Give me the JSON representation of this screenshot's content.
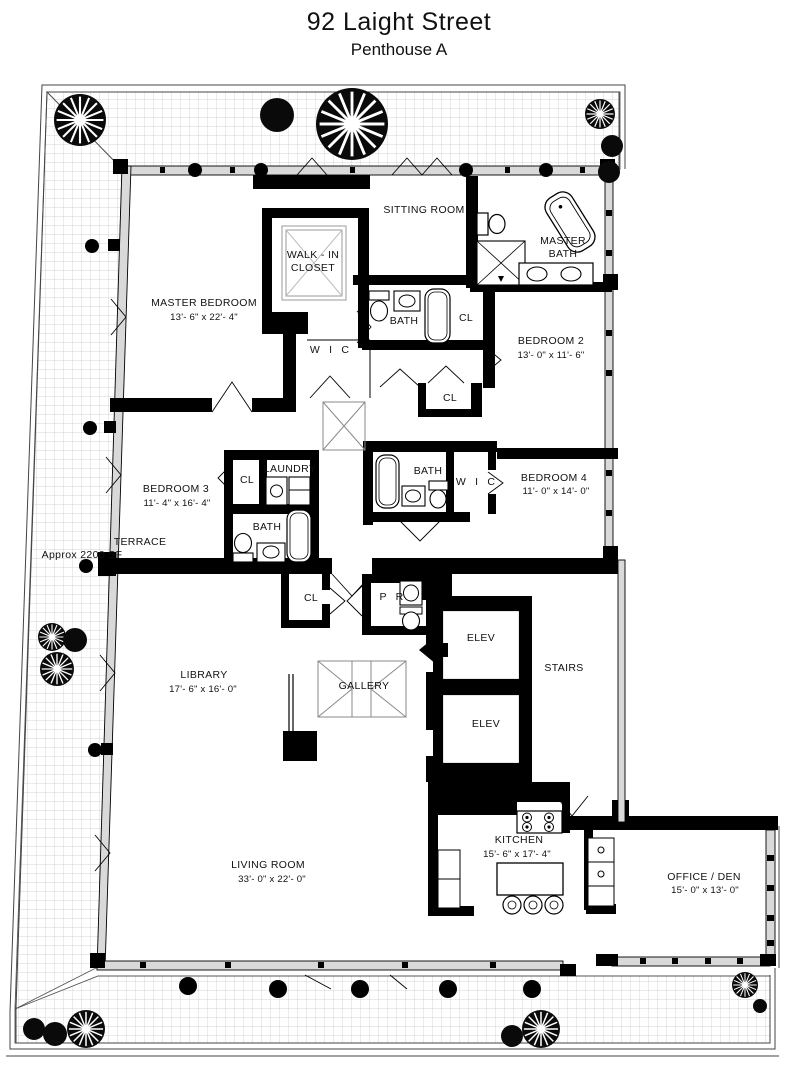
{
  "header": {
    "title": "92 Laight Street",
    "subtitle": "Penthouse A"
  },
  "terrace": {
    "name": "TERRACE",
    "area": "Approx 2200 SF"
  },
  "rooms": {
    "sitting_room": {
      "name": "SITTING ROOM"
    },
    "walk_in_closet": {
      "line1": "WALK - IN",
      "line2": "CLOSET"
    },
    "master_bath": {
      "line1": "MASTER",
      "line2": "BATH"
    },
    "master_bedroom": {
      "name": "MASTER BEDROOM",
      "dims": "13'- 6\" x 22'- 4\""
    },
    "bath_hall": {
      "name": "BATH"
    },
    "cl_hall": {
      "name": "CL"
    },
    "wic_master": {
      "name": "W I C"
    },
    "bedroom_2": {
      "name": "BEDROOM 2",
      "dims": "13'- 0\" x 11'- 6\""
    },
    "cl_bedroom2": {
      "name": "CL"
    },
    "bedroom_3": {
      "name": "BEDROOM 3",
      "dims": "11'- 4\" x 16'- 4\""
    },
    "cl_bedroom3": {
      "name": "CL"
    },
    "laundry": {
      "name": "LAUNDRY"
    },
    "bath_bedroom3": {
      "name": "BATH"
    },
    "bath_bedroom4": {
      "name": "BATH"
    },
    "wic_bedroom4": {
      "name": "W I C"
    },
    "bedroom_4": {
      "name": "BEDROOM 4",
      "dims": "11'- 0\" x 14'- 0\""
    },
    "cl_gallery": {
      "name": "CL"
    },
    "powder_room": {
      "name": "P R"
    },
    "library": {
      "name": "LIBRARY",
      "dims": "17'- 6\" x 16'- 0\""
    },
    "gallery": {
      "name": "GALLERY"
    },
    "elevator_1": {
      "name": "ELEV"
    },
    "elevator_2": {
      "name": "ELEV"
    },
    "stairs": {
      "name": "STAIRS"
    },
    "living_room": {
      "name": "LIVING ROOM",
      "dims": "33'- 0\" x 22'- 0\""
    },
    "kitchen": {
      "name": "KITCHEN",
      "dims": "15'- 6\" x 17'- 4\""
    },
    "office_den": {
      "name": "OFFICE / DEN",
      "dims": "15'- 0\" x 13'- 0\""
    }
  },
  "icons": {
    "tree": "tree-icon",
    "bush": "bush-icon",
    "bathtub": "bathtub-icon",
    "toilet": "toilet-icon",
    "sink": "sink-icon",
    "shower": "shower-icon",
    "stove": "stove-icon",
    "island": "kitchen-island-icon",
    "stool": "stool-icon",
    "washer": "washer-icon",
    "dryer": "dryer-icon",
    "entry_arrow": "entry-arrow-icon",
    "skylight": "skylight-icon",
    "column": "column-icon"
  },
  "colors": {
    "ink": "#000000",
    "wall_fill": "#d9d9d9",
    "grid_line": "#c6c6c6",
    "background": "#ffffff"
  }
}
